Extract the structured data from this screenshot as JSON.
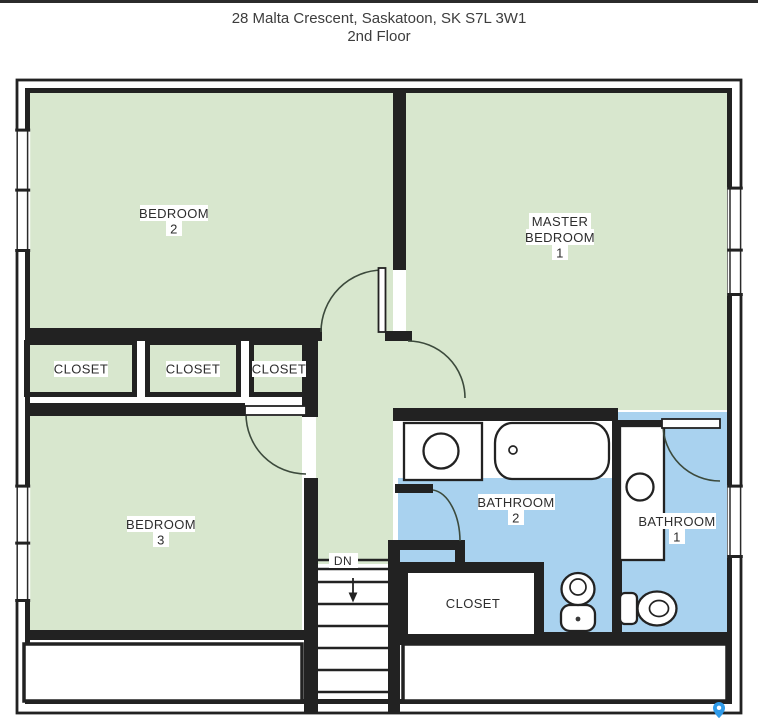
{
  "header": {
    "address": "28 Malta Crescent, Saskatoon, SK S7L 3W1",
    "floor_label": "2nd Floor"
  },
  "colors": {
    "room_green": "#d8e7ce",
    "bath_blue": "#a9d2ef",
    "wall_dark": "#222222",
    "door_arc": "#3c4a3c",
    "pin_blue": "#2f9bea",
    "top_bar": "#2b2b2b"
  },
  "rooms": {
    "bedroom2": {
      "name": "BEDROOM",
      "number": "2"
    },
    "master_bedroom": {
      "name_line1": "MASTER",
      "name_line2": "BEDROOM",
      "number": "1"
    },
    "bedroom3": {
      "name": "BEDROOM",
      "number": "3"
    },
    "closet_left": {
      "name": "CLOSET"
    },
    "closet_middle": {
      "name": "CLOSET"
    },
    "closet_right": {
      "name": "CLOSET"
    },
    "bathroom2": {
      "name": "BATHROOM",
      "number": "2"
    },
    "bathroom1": {
      "name": "BATHROOM",
      "number": "1"
    },
    "hall_closet": {
      "name": "CLOSET"
    },
    "stairs": {
      "direction_label": "DN"
    }
  }
}
